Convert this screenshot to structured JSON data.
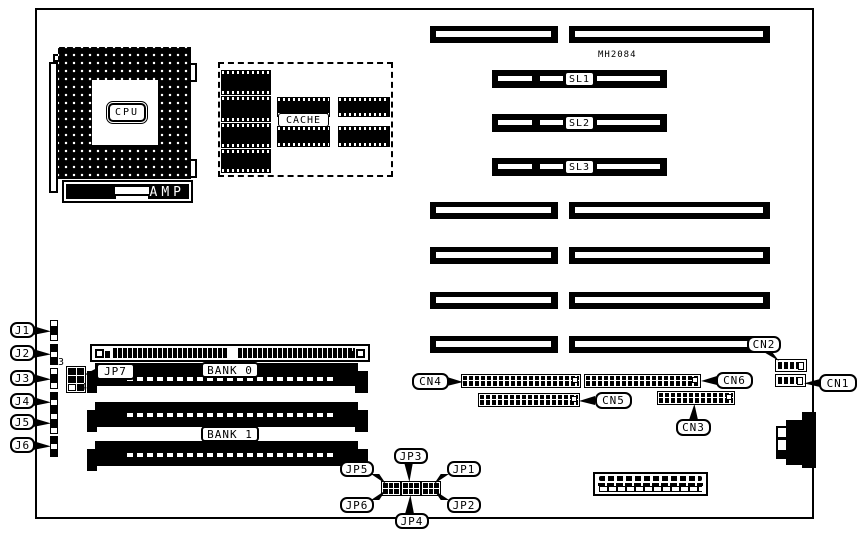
{
  "cpu": {
    "label": "CPU",
    "brand": "AMP"
  },
  "cache": {
    "label": "CACHE"
  },
  "ic_label": "MH2084",
  "sl": [
    "SL1",
    "SL2",
    "SL3"
  ],
  "banks": [
    "BANK 0",
    "BANK 1"
  ],
  "j": [
    "J1",
    "J2",
    "J3",
    "J4",
    "J5",
    "J6"
  ],
  "jp": [
    "JP1",
    "JP2",
    "JP3",
    "JP4",
    "JP5",
    "JP6",
    "JP7"
  ],
  "jp7_pins": {
    "pin3": "3",
    "pin4": "4"
  },
  "cn": [
    "CN1",
    "CN2",
    "CN3",
    "CN4",
    "CN5",
    "CN6"
  ],
  "colors": {
    "ink": "#000000",
    "paper": "#ffffff"
  }
}
